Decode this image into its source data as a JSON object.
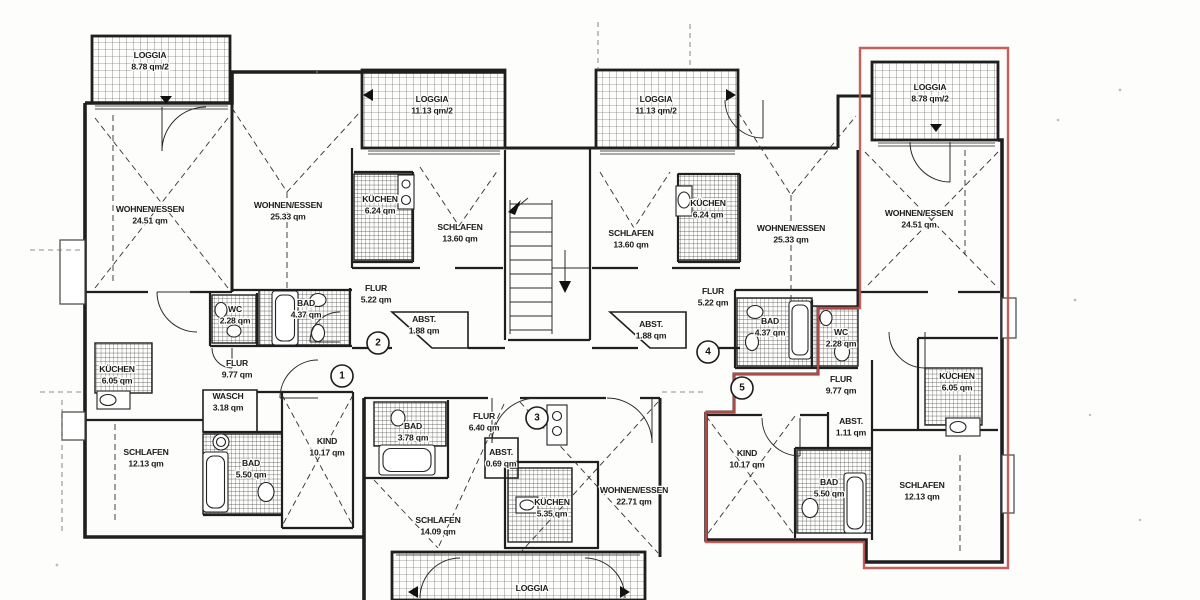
{
  "meta": {
    "title": "Grundriss-Scan Dachgeschoss Mehrfamilienhaus",
    "area_unit": "qm",
    "highlight_color": "#bf4f4b",
    "paper_color": "#fdfdfb",
    "ink_color": "#1f1f1f"
  },
  "units": [
    "1",
    "2",
    "3",
    "4",
    "5"
  ],
  "rooms": [
    {
      "name": "LOGGIA",
      "area": "8.78 qm/2"
    },
    {
      "name": "WOHNEN/ESSEN",
      "area": "24.51 qm"
    },
    {
      "name": "KÜCHEN",
      "area": "6.05 qm"
    },
    {
      "name": "WC",
      "area": "2.28 qm"
    },
    {
      "name": "BAD",
      "area": "4.37 qm"
    },
    {
      "name": "FLUR",
      "area": "9.77 qm"
    },
    {
      "name": "WASCH",
      "area": "3.18 qm"
    },
    {
      "name": "SCHLAFEN",
      "area": "12.13 qm"
    },
    {
      "name": "BAD",
      "area": "5.50 qm"
    },
    {
      "name": "KIND",
      "area": "10.17 qm"
    },
    {
      "name": "WOHNEN/ESSEN",
      "area": "25.33 qm"
    },
    {
      "name": "LOGGIA",
      "area": "11.13 qm/2"
    },
    {
      "name": "KÜCHEN",
      "area": "6.24 qm"
    },
    {
      "name": "SCHLAFEN",
      "area": "13.60 qm"
    },
    {
      "name": "FLUR",
      "area": "5.22 qm"
    },
    {
      "name": "ABST.",
      "area": "1.88 qm"
    },
    {
      "name": "LOGGIA",
      "area": "11.13 qm/2"
    },
    {
      "name": "SCHLAFEN",
      "area": "13.60 qm"
    },
    {
      "name": "KÜCHEN",
      "area": "6.24 qm"
    },
    {
      "name": "WOHNEN/ESSEN",
      "area": "25.33 qm"
    },
    {
      "name": "ABST.",
      "area": "1.88 qm"
    },
    {
      "name": "FLUR",
      "area": "5.22 qm"
    },
    {
      "name": "LOGGIA",
      "area": "8.78 qm/2"
    },
    {
      "name": "WOHNEN/ESSEN",
      "area": "24.51 qm"
    },
    {
      "name": "BAD",
      "area": "4.37 qm"
    },
    {
      "name": "WC",
      "area": "2.28 qm"
    },
    {
      "name": "FLUR",
      "area": "9.77 qm"
    },
    {
      "name": "ABST.",
      "area": "1.11 qm"
    },
    {
      "name": "KIND",
      "area": "10.17 qm"
    },
    {
      "name": "BAD",
      "area": "5.50 qm"
    },
    {
      "name": "KÜCHEN",
      "area": "6.05 qm"
    },
    {
      "name": "SCHLAFEN",
      "area": "12.13 qm"
    },
    {
      "name": "BAD",
      "area": "3.78 qm"
    },
    {
      "name": "FLUR",
      "area": "6.40 qm"
    },
    {
      "name": "ABST.",
      "area": "0.69 qm"
    },
    {
      "name": "KÜCHEN",
      "area": "5.35 qm"
    },
    {
      "name": "WOHNEN/ESSEN",
      "area": "22.71 qm"
    },
    {
      "name": "SCHLAFEN",
      "area": "14.09 qm"
    },
    {
      "name": "LOGGIA",
      "area": ""
    }
  ]
}
